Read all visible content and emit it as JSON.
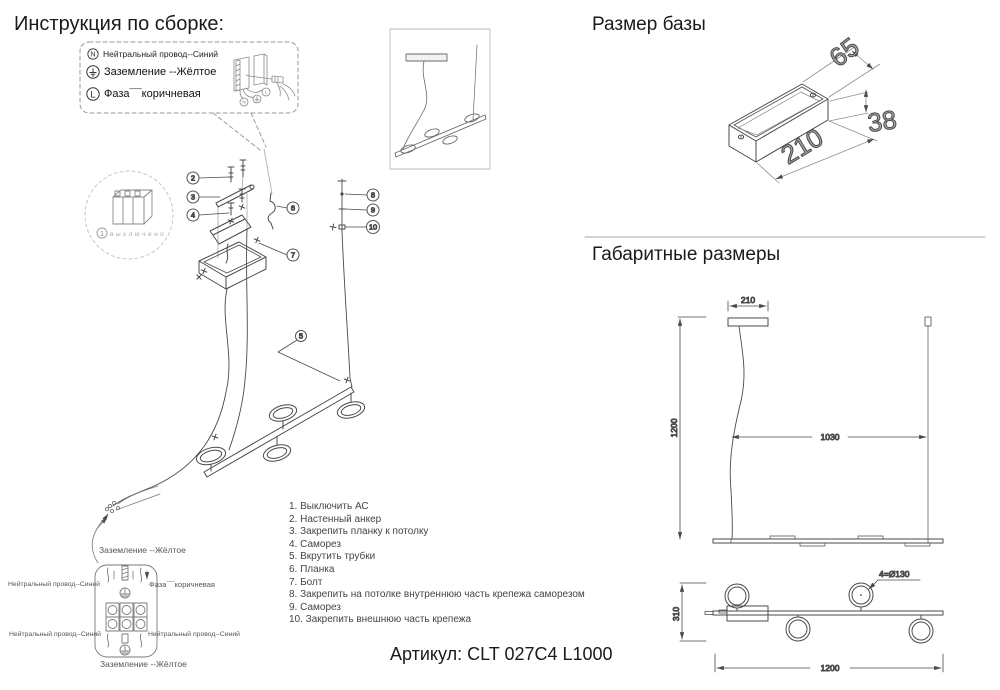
{
  "page": {
    "title": "Инструкция по сборке:",
    "article": "Артикул: CLT 027C4 L1000"
  },
  "legend": {
    "items": [
      {
        "symbol": "N",
        "label": "Нейтральный провод--Синий"
      },
      {
        "symbol": "⏚",
        "label": "Заземление --Жёлтое"
      },
      {
        "symbol": "L",
        "label": "Фаза¯¯коричневая"
      }
    ]
  },
  "assembly": {
    "power_off_step": "1",
    "power_off_note": "выключено",
    "callouts": {
      "anchor": "2",
      "plank": "3",
      "screw": "4",
      "tubes": "5",
      "hook": "6",
      "bolt": "7",
      "cable_top": "8",
      "cable_mid": "9",
      "cable_bot": "10"
    }
  },
  "steps": [
    "1. Выключить АС",
    "2. Настенный анкер",
    "3. Закрепить планку к потолку",
    "4. Саморез",
    "5. Вкрутить трубки",
    "6. Планка",
    "7. Болт",
    "8. Закрепить на потолке внутреннюю часть крепежа саморезом",
    "9. Саморез",
    "10. Закрепить внешнюю часть крепежа"
  ],
  "base_size": {
    "heading": "Размер базы",
    "width": "65",
    "height": "38",
    "length": "210"
  },
  "overall": {
    "heading": "Габаритные размеры",
    "front": {
      "canopy": "210",
      "drop": "1200",
      "span": "1030"
    },
    "bottom": {
      "height": "310",
      "length": "1200",
      "rings": "4=Ø130"
    }
  },
  "wiring": {
    "ground_top": "Заземление --Жёлтое",
    "neutral_left": "Нейтральный провод--Синий",
    "phase_right": "Фаза¯¯коричневая",
    "neutral_left2": "Нейтральный провод--Синий",
    "neutral_right2": "Нейтральный провод--Синий",
    "ground_bottom": "Заземление --Жёлтое"
  },
  "colors": {
    "line": "#4a4a4a",
    "light": "#9a9a9a",
    "big_dim": "#a8a8a8"
  }
}
